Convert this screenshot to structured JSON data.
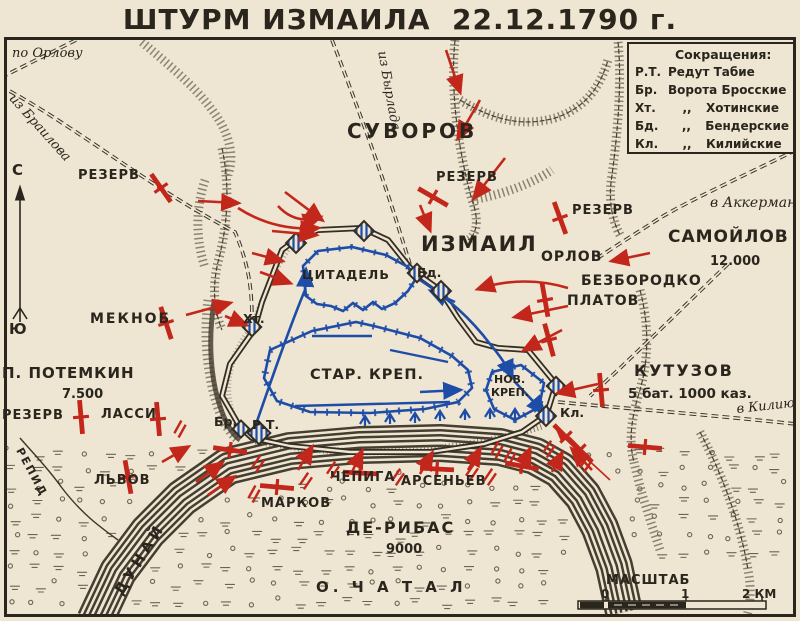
{
  "title": "ШТУРМ ИЗМАИЛА  22.12.1790 г.",
  "colors": {
    "background": "#eee6d2",
    "ink": "#2a251d",
    "red": "#c3271b",
    "blue": "#1e4da8"
  },
  "legend": {
    "heading": "Сокращения:",
    "rows": [
      {
        "abbr": "Р.Т.",
        "ditto": "",
        "term": "Редут Табие"
      },
      {
        "abbr": "Бр.",
        "ditto": "",
        "term": "Ворота Бросские"
      },
      {
        "abbr": "Хт.",
        "ditto": ",,",
        "term": "Хотинские"
      },
      {
        "abbr": "Бд.",
        "ditto": ",,",
        "term": "Бендерские"
      },
      {
        "abbr": "Кл.",
        "ditto": ",,",
        "term": "Килийские"
      }
    ]
  },
  "compass": {
    "north": "С",
    "south": "Ю"
  },
  "scale": {
    "label": "МАСШТАБ",
    "tick0": "0",
    "tick1": "1",
    "tick2": "2 КМ"
  },
  "labels": {
    "po_orlovu": "по Орлову",
    "iz_brailova": "из Браилова",
    "iz_byrlada": "из Бырлада",
    "suvorov": "СУВОРОВ",
    "rezerv_nw": "РЕЗЕРВ",
    "rezerv_n": "РЕЗЕРВ",
    "rezerv_e": "РЕЗЕРВ",
    "rezerv_sw": "РЕЗЕРВ",
    "v_akkerman": "в Аккерман",
    "izmail": "ИЗМАИЛ",
    "samoylov": "САМОЙЛОВ",
    "samoylov_num": "12.000",
    "orlov": "ОРЛОВ",
    "bezborodko": "БЕЗБОРОДКО",
    "platov": "ПЛАТОВ",
    "tsitadel": "ЦИТАДЕЛЬ",
    "bd": "Бд.",
    "meknob": "МЕКНОБ",
    "ht": "Хт.",
    "potemkin": "П. ПОТЕМКИН",
    "potemkin_num": "7.500",
    "kutuzov": "КУТУЗОВ",
    "kutuzov_num": "5 бат. 1000 каз.",
    "v_kiliyu": "в Килию",
    "lassi": "ЛАССИ",
    "br": "Бр.",
    "rt": "Р.Т.",
    "kl": "Кл.",
    "star_krep": "СТАР. КРЕП.",
    "nov_krep_1": "НОВ.",
    "nov_krep_2": "КРЕП.",
    "lvov": "ЛЬВОВ",
    "chepiga": "ЧЕПИГА",
    "arsenyev": "АРСЕНЬЕВ",
    "markov": "МАРКОВ",
    "de_ribas": "ДЕ-РИБАС",
    "de_ribas_num": "9000",
    "o_chatal": "О. Ч А Т А Л",
    "repid": "РЕПИД",
    "dunay": "ДУНАЙ",
    "masshtab": "МАСШТАБ"
  }
}
